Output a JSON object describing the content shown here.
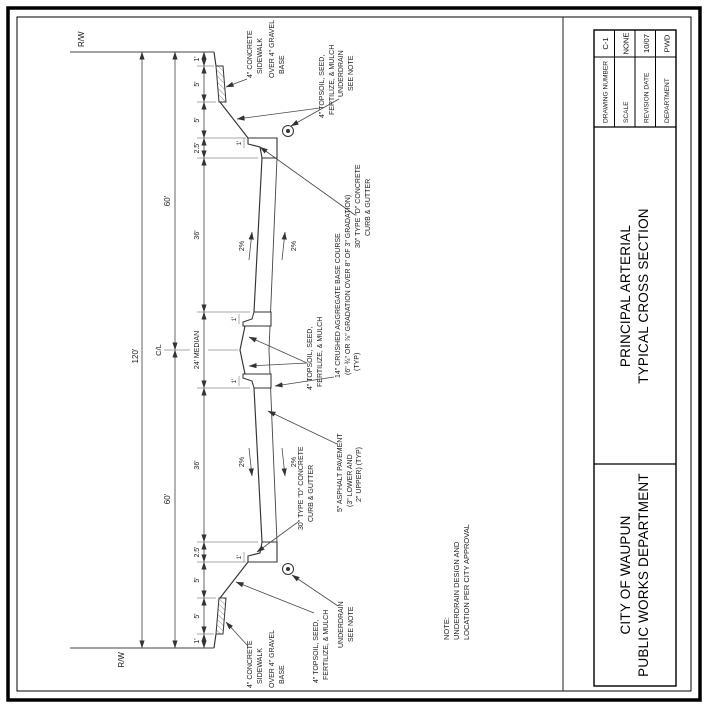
{
  "title_block": {
    "city": [
      "CITY OF WAUPUN",
      "PUBLIC WORKS DEPARTMENT"
    ],
    "title": [
      "PRINCIPAL ARTERIAL",
      "TYPICAL CROSS SECTION"
    ],
    "info": [
      {
        "label": "DRAWING NUMBER",
        "value": "C-1"
      },
      {
        "label": "SCALE",
        "value": "NONE"
      },
      {
        "label": "REVISION DATE",
        "value": "10/07"
      },
      {
        "label": "DEPARTMENT",
        "value": "PWD"
      }
    ]
  },
  "dims": {
    "rw": "R/W",
    "overall": "120'",
    "half": "60'",
    "cl": "C/L",
    "chain": [
      "1'",
      "5'",
      "5'",
      "2.5'",
      "36'",
      "24' MEDIAN",
      "36'",
      "2.5'",
      "5'",
      "5'",
      "1'"
    ],
    "curb_head": "1'",
    "slope": "2%"
  },
  "annotations": {
    "sidewalk": [
      "4\" CONCRETE",
      "SIDEWALK",
      "OVER 4\" GRAVEL",
      "BASE"
    ],
    "topsoil": [
      "4\" TOPSOIL, SEED,",
      "FERTILIZE, & MULCH"
    ],
    "underdrain": [
      "UNDERDRAIN",
      "SEE NOTE"
    ],
    "curb": [
      "30\" TYPE \"D\" CONCRETE",
      "CURB & GUTTER"
    ],
    "asphalt": [
      "5\" ASPHALT PAVEMENT",
      "(3\" LOWER AND",
      "2\" UPPER) (TYP)"
    ],
    "aggregate": [
      "14\" CRUSHED AGGREGATE BASE COURSE",
      "(6\" ¾\" OR ⅞\" GRADATION OVER 8\" OF 3\" GRADATION)",
      "(TYP)"
    ]
  },
  "note": [
    "NOTE:",
    "UNDERDRAIN DESIGN AND",
    "LOCATION PER CITY APPROVAL"
  ]
}
